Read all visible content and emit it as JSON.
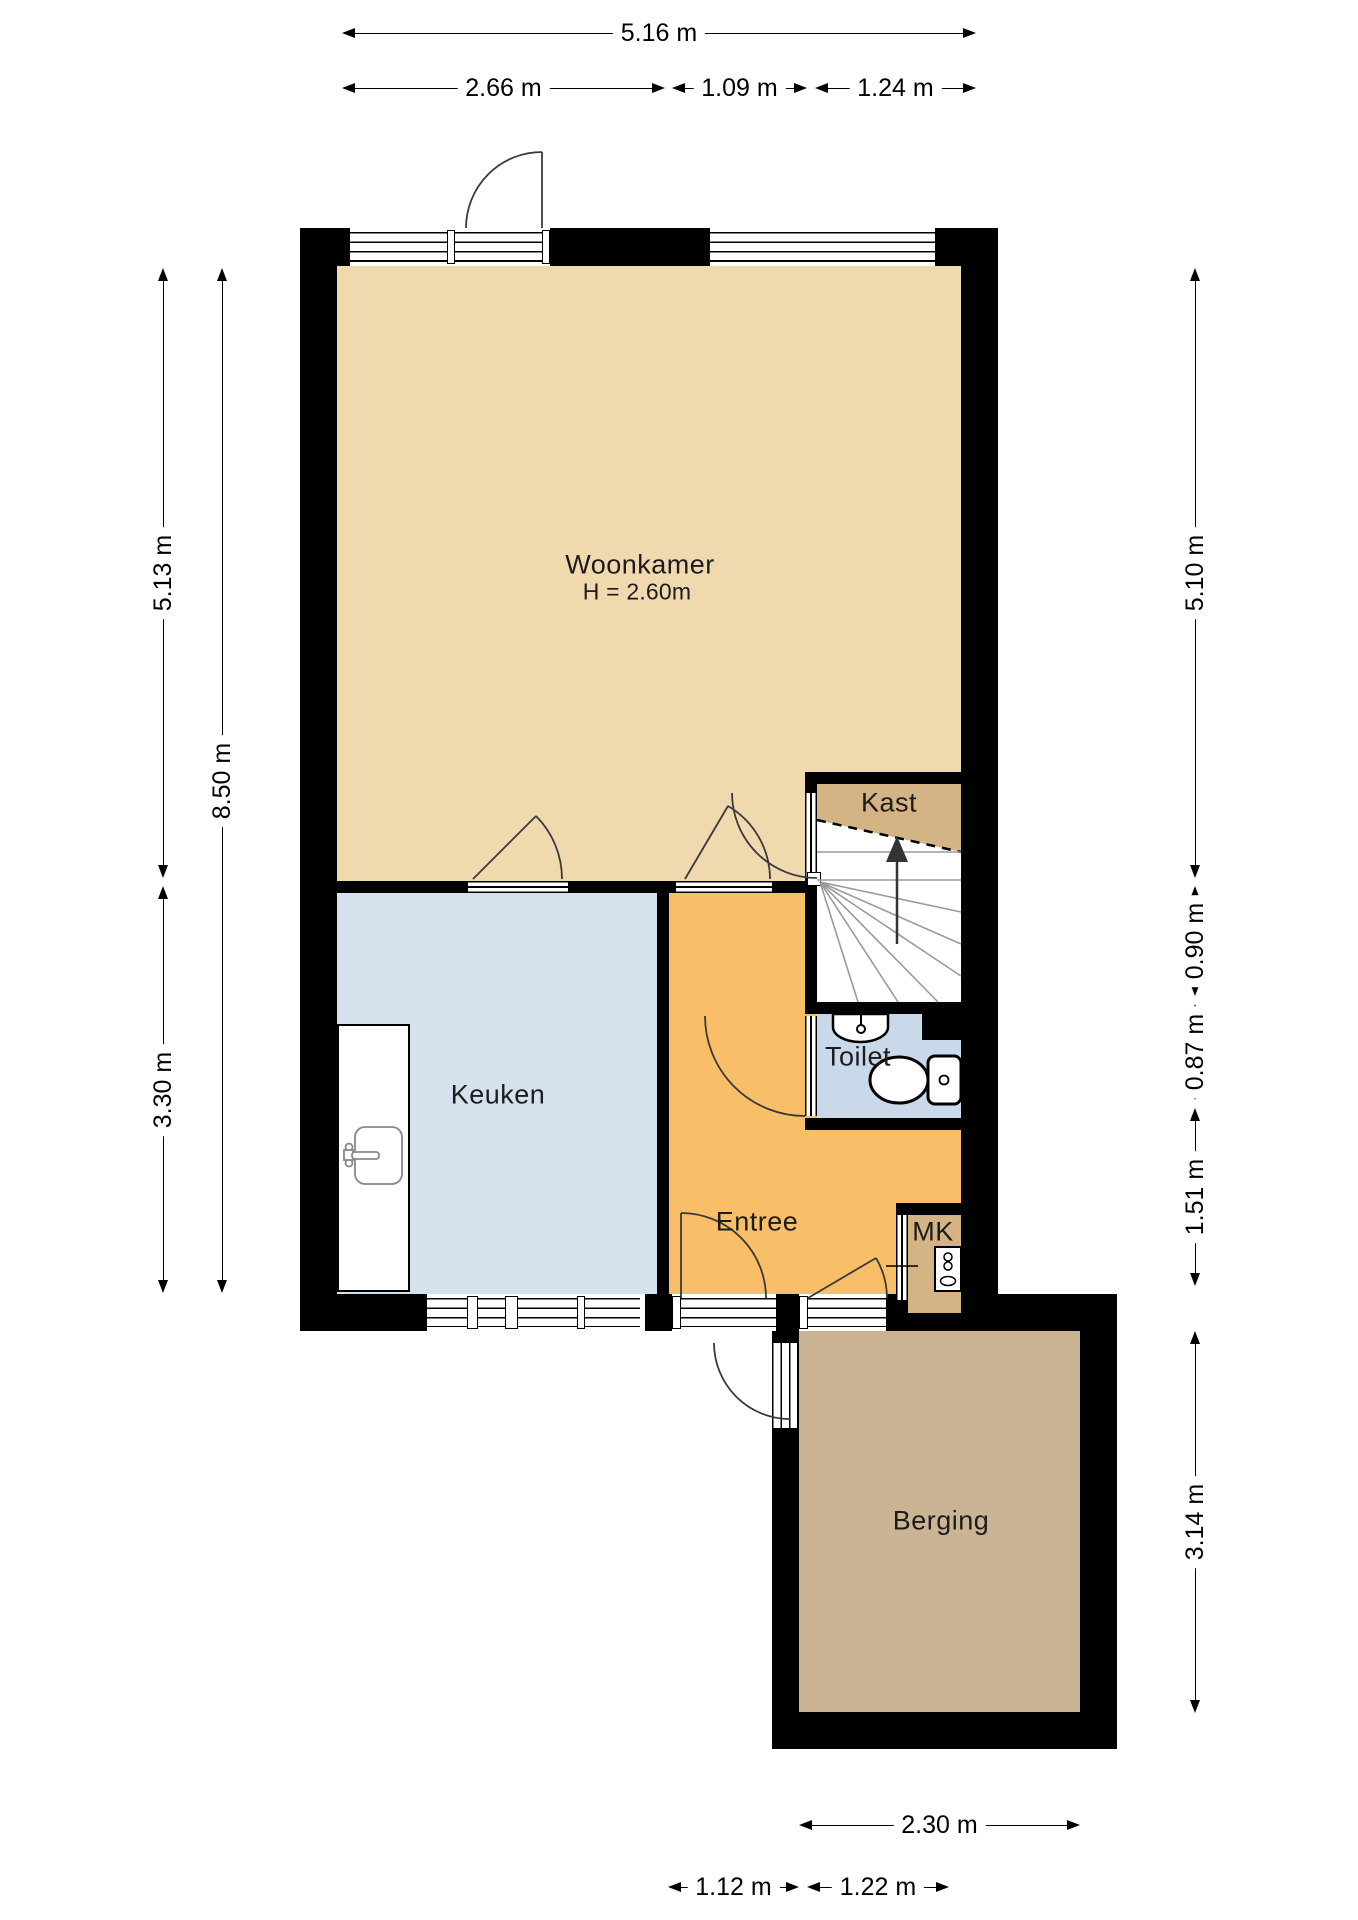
{
  "rooms": {
    "woonkamer": {
      "label": "Woonkamer",
      "height_note": "H = 2.60m",
      "color": "#F0D9AE"
    },
    "keuken": {
      "label": "Keuken",
      "color": "#D5E1ED"
    },
    "entree": {
      "label": "Entree",
      "color": "#F8BE68"
    },
    "toilet": {
      "label": "Toilet",
      "color": "#C9D9E9"
    },
    "kast": {
      "label": "Kast",
      "color": "#D4B384"
    },
    "mk": {
      "label": "MK",
      "color": "#D4B384"
    },
    "berging": {
      "label": "Berging",
      "color": "#CBB493"
    }
  },
  "dimensions": {
    "top_total": "5.16 m",
    "top_1": "2.66 m",
    "top_2": "1.09 m",
    "top_3": "1.24 m",
    "left_upper": "5.13 m",
    "left_total": "8.50 m",
    "left_lower": "3.30 m",
    "right_1": "5.10 m",
    "right_2": "0.90 m",
    "right_3": "0.87 m",
    "right_4": "1.51 m",
    "right_5": "3.14 m",
    "bottom_total": "2.30 m",
    "bottom_1": "1.12 m",
    "bottom_2": "1.22 m"
  },
  "colors": {
    "wall": "#000000",
    "dimension_text": "#000000",
    "stair_tread": "#9A9A9A",
    "door_swing": "#3A3A3A",
    "background": "#FFFFFF"
  }
}
